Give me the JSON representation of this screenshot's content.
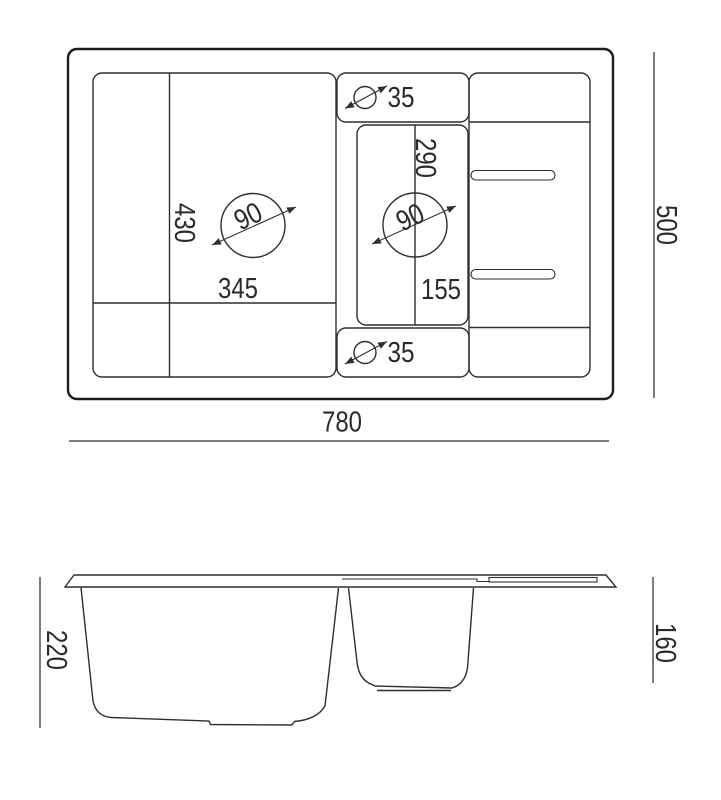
{
  "top_view": {
    "overall_width": "780",
    "overall_depth": "500",
    "main_bowl_width": "345",
    "main_bowl_depth": "430",
    "main_bowl_drain_diameter": "90",
    "small_bowl_drain_diameter": "90",
    "tap_hole_top_diameter": "35",
    "tap_hole_bottom_diameter": "35",
    "small_bowl_upper_dimension": "290",
    "small_bowl_lower_dimension": "155"
  },
  "side_view": {
    "main_bowl_depth": "220",
    "small_bowl_depth": "160"
  },
  "colors": {
    "line": "#2f2f2f",
    "outline": "#1c1c1c",
    "text": "#2b2b2b",
    "background": "#ffffff"
  }
}
